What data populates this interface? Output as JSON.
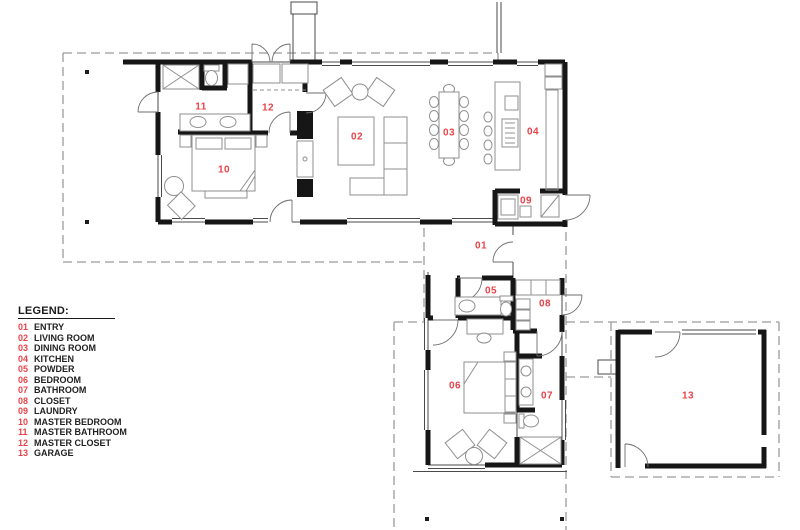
{
  "legend": {
    "title": "LEGEND:",
    "items": [
      {
        "num": "01",
        "name": "ENTRY"
      },
      {
        "num": "02",
        "name": "LIVING ROOM"
      },
      {
        "num": "03",
        "name": "DINING ROOM"
      },
      {
        "num": "04",
        "name": "KITCHEN"
      },
      {
        "num": "05",
        "name": "POWDER"
      },
      {
        "num": "06",
        "name": "BEDROOM"
      },
      {
        "num": "07",
        "name": "BATHROOM"
      },
      {
        "num": "08",
        "name": "CLOSET"
      },
      {
        "num": "09",
        "name": "LAUNDRY"
      },
      {
        "num": "10",
        "name": "MASTER BEDROOM"
      },
      {
        "num": "11",
        "name": "MASTER BATHROOM"
      },
      {
        "num": "12",
        "name": "MASTER CLOSET"
      },
      {
        "num": "13",
        "name": "GARAGE"
      }
    ]
  },
  "room_labels": [
    {
      "num": "01",
      "x": 481,
      "y": 246
    },
    {
      "num": "02",
      "x": 357,
      "y": 137
    },
    {
      "num": "03",
      "x": 449,
      "y": 133
    },
    {
      "num": "04",
      "x": 533,
      "y": 132
    },
    {
      "num": "05",
      "x": 491,
      "y": 291
    },
    {
      "num": "06",
      "x": 455,
      "y": 386
    },
    {
      "num": "07",
      "x": 547,
      "y": 396
    },
    {
      "num": "08",
      "x": 545,
      "y": 304
    },
    {
      "num": "09",
      "x": 526,
      "y": 201
    },
    {
      "num": "10",
      "x": 224,
      "y": 170
    },
    {
      "num": "11",
      "x": 201,
      "y": 107
    },
    {
      "num": "12",
      "x": 268,
      "y": 108
    },
    {
      "num": "13",
      "x": 688,
      "y": 396
    }
  ],
  "colors": {
    "label": "#e8434a",
    "wall": "#161616",
    "roofline": "#9b9b9b",
    "furniture": "#8f8f8f"
  }
}
